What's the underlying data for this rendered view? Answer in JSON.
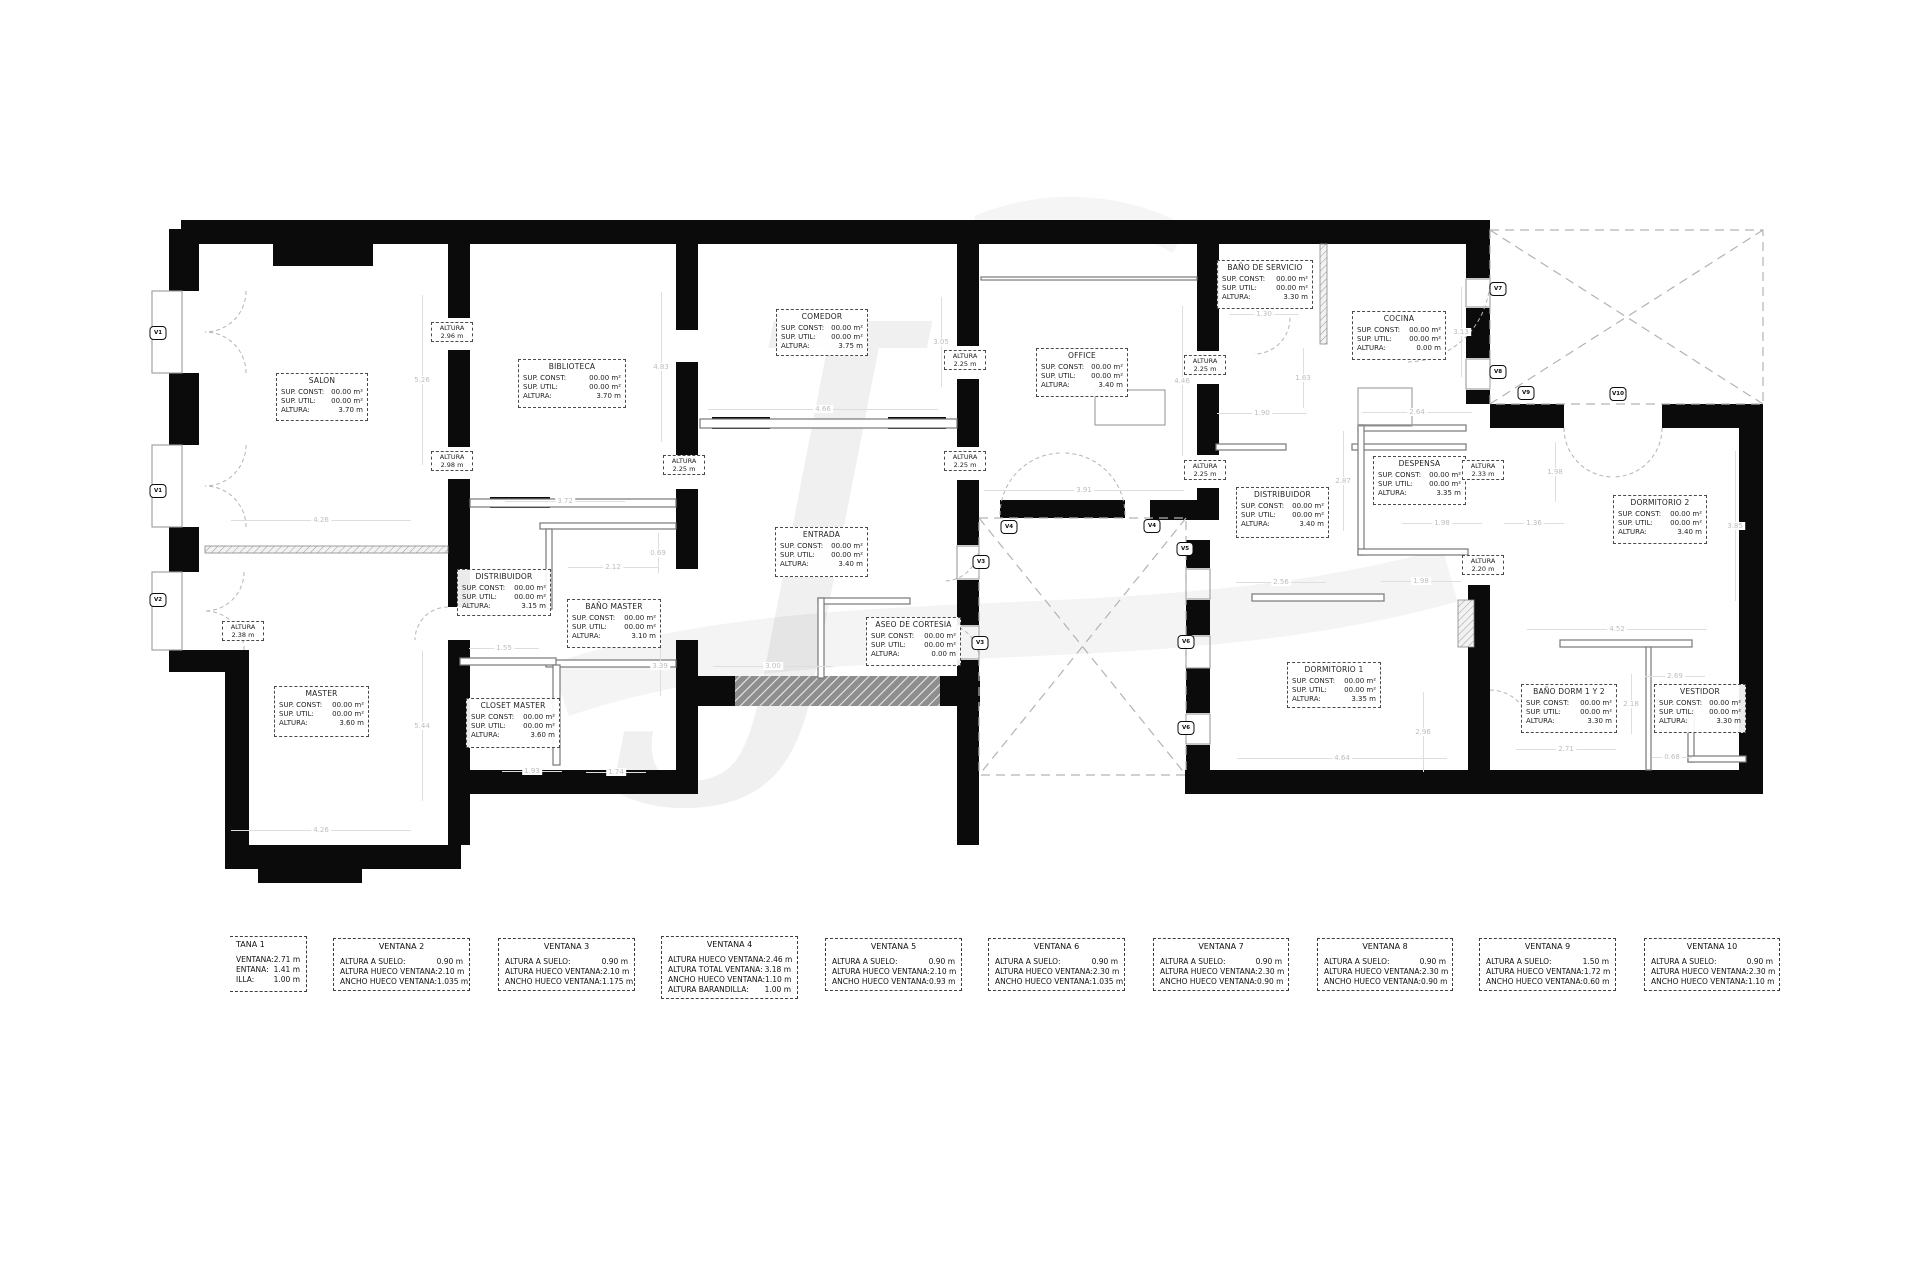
{
  "watermark": {
    "glyph": "J"
  },
  "plan": {
    "labels": {
      "sup_const": "SUP. CONST:",
      "sup_util": "SUP. UTIL:",
      "altura": "ALTURA:",
      "altura_word": "ALTURA"
    },
    "rooms": [
      {
        "name": "SALON",
        "sup_const": "00.00 m²",
        "sup_util": "00.00 m²",
        "altura": "3.70 m"
      },
      {
        "name": "BIBLIOTECA",
        "sup_const": "00.00 m²",
        "sup_util": "00.00 m²",
        "altura": "3.70 m"
      },
      {
        "name": "COMEDOR",
        "sup_const": "00.00 m²",
        "sup_util": "00.00 m²",
        "altura": "3.75 m"
      },
      {
        "name": "OFFICE",
        "sup_const": "00.00 m²",
        "sup_util": "00.00 m²",
        "altura": "3.40 m"
      },
      {
        "name": "BAÑO DE SERVICIO",
        "sup_const": "00.00 m²",
        "sup_util": "00.00 m²",
        "altura": "3.30 m"
      },
      {
        "name": "COCINA",
        "sup_const": "00.00 m²",
        "sup_util": "00.00 m²",
        "altura": "0.00 m"
      },
      {
        "name": "DESPENSA",
        "sup_const": "00.00 m²",
        "sup_util": "00.00 m²",
        "altura": "3.35 m"
      },
      {
        "name": "DISTRIBUIDOR",
        "sup_const": "00.00 m²",
        "sup_util": "00.00 m²",
        "altura": "3.40 m"
      },
      {
        "name": "DISTRIBUIDOR",
        "sup_const": "00.00 m²",
        "sup_util": "00.00 m²",
        "altura": "3.15 m"
      },
      {
        "name": "BAÑO MASTER",
        "sup_const": "00.00 m²",
        "sup_util": "00.00 m²",
        "altura": "3.10 m"
      },
      {
        "name": "MASTER",
        "sup_const": "00.00 m²",
        "sup_util": "00.00 m²",
        "altura": "3.60 m"
      },
      {
        "name": "CLOSET MASTER",
        "sup_const": "00.00 m²",
        "sup_util": "00.00 m²",
        "altura": "3.60 m"
      },
      {
        "name": "ENTRADA",
        "sup_const": "00.00 m²",
        "sup_util": "00.00 m²",
        "altura": "3.40 m"
      },
      {
        "name": "ASEO DE CORTESIA",
        "sup_const": "00.00 m²",
        "sup_util": "00.00 m²",
        "altura": "0.00 m"
      },
      {
        "name": "DORMITORIO 1",
        "sup_const": "00.00 m²",
        "sup_util": "00.00 m²",
        "altura": "3.35 m"
      },
      {
        "name": "BAÑO DORM 1 Y 2",
        "sup_const": "00.00 m²",
        "sup_util": "00.00 m²",
        "altura": "3.30 m"
      },
      {
        "name": "VESTIDOR",
        "sup_const": "00.00 m²",
        "sup_util": "00.00 m²",
        "altura": "3.30 m"
      },
      {
        "name": "DORMITORIO 2",
        "sup_const": "00.00 m²",
        "sup_util": "00.00 m²",
        "altura": "3.40 m"
      }
    ],
    "altura_tags": [
      "2.96 m",
      "2.98 m",
      "2.25 m",
      "2.25 m",
      "2.25 m",
      "2.25 m",
      "2.25 m",
      "2.33 m",
      "2.20 m",
      "2.38 m"
    ],
    "dimensions": [
      "5.26",
      "4.26",
      "4.26",
      "3.72",
      "4.83",
      "4.66",
      "3.05",
      "3.91",
      "4.46",
      "1.30",
      "1.63",
      "1.90",
      "2.64",
      "3.13",
      "2.87",
      "1.98",
      "1.98",
      "1.36",
      "1.98",
      "2.56",
      "2.96",
      "4.64",
      "2.71",
      "4.52",
      "2.18",
      "2.69",
      "0.68",
      "3.85",
      "0.69",
      "2.12",
      "1.55",
      "3.39",
      "5.44",
      "3.00",
      "1.93",
      "1.74"
    ],
    "window_markers": [
      "V1",
      "V1",
      "V2",
      "V3",
      "V3",
      "V4",
      "V4",
      "V5",
      "V6",
      "V6",
      "V7",
      "V8",
      "V9",
      "V10"
    ]
  },
  "ventanas": [
    {
      "title": "TANA 1",
      "clipped": true,
      "rows": [
        {
          "label": "VENTANA:",
          "value": "2.71 m"
        },
        {
          "label": "ENTANA:",
          "value": "1.41 m"
        },
        {
          "label": "ILLA:",
          "value": "1.00 m"
        }
      ]
    },
    {
      "title": "VENTANA 2",
      "rows": [
        {
          "label": "ALTURA A SUELO:",
          "value": "0.90 m"
        },
        {
          "label": "ALTURA HUECO VENTANA:",
          "value": "2.10 m"
        },
        {
          "label": "ANCHO HUECO VENTANA:",
          "value": "1.035 m"
        }
      ]
    },
    {
      "title": "VENTANA 3",
      "rows": [
        {
          "label": "ALTURA A SUELO:",
          "value": "0.90 m"
        },
        {
          "label": "ALTURA HUECO VENTANA:",
          "value": "2.10 m"
        },
        {
          "label": "ANCHO HUECO VENTANA:",
          "value": "1.175 m"
        }
      ]
    },
    {
      "title": "VENTANA 4",
      "rows": [
        {
          "label": "ALTURA HUECO VENTANA:",
          "value": "2.46 m"
        },
        {
          "label": "ALTURA TOTAL VENTANA:",
          "value": "3.18 m"
        },
        {
          "label": "ANCHO HUECO VENTANA:",
          "value": "1.10 m"
        },
        {
          "label": "ALTURA BARANDILLA:",
          "value": "1.00 m"
        }
      ]
    },
    {
      "title": "VENTANA 5",
      "rows": [
        {
          "label": "ALTURA A SUELO:",
          "value": "0.90 m"
        },
        {
          "label": "ALTURA HUECO VENTANA:",
          "value": "2.10 m"
        },
        {
          "label": "ANCHO HUECO VENTANA:",
          "value": "0.93 m"
        }
      ]
    },
    {
      "title": "VENTANA 6",
      "rows": [
        {
          "label": "ALTURA A SUELO:",
          "value": "0.90 m"
        },
        {
          "label": "ALTURA HUECO VENTANA:",
          "value": "2.30 m"
        },
        {
          "label": "ANCHO HUECO VENTANA:",
          "value": "1.035 m"
        }
      ]
    },
    {
      "title": "VENTANA 7",
      "rows": [
        {
          "label": "ALTURA A SUELO:",
          "value": "0.90 m"
        },
        {
          "label": "ALTURA HUECO VENTANA:",
          "value": "2.30 m"
        },
        {
          "label": "ANCHO HUECO VENTANA:",
          "value": "0.90 m"
        }
      ]
    },
    {
      "title": "VENTANA 8",
      "rows": [
        {
          "label": "ALTURA A SUELO:",
          "value": "0.90 m"
        },
        {
          "label": "ALTURA HUECO VENTANA:",
          "value": "2.30 m"
        },
        {
          "label": "ANCHO HUECO VENTANA:",
          "value": "0.90 m"
        }
      ]
    },
    {
      "title": "VENTANA 9",
      "rows": [
        {
          "label": "ALTURA A SUELO:",
          "value": "1.50 m"
        },
        {
          "label": "ALTURA HUECO VENTANA:",
          "value": "1.72 m"
        },
        {
          "label": "ANCHO HUECO VENTANA:",
          "value": "0.60 m"
        }
      ]
    },
    {
      "title": "VENTANA 10",
      "rows": [
        {
          "label": "ALTURA A SUELO:",
          "value": "0.90 m"
        },
        {
          "label": "ALTURA HUECO VENTANA:",
          "value": "2.30 m"
        },
        {
          "label": "ANCHO HUECO VENTANA:",
          "value": "1.10 m"
        }
      ]
    }
  ]
}
